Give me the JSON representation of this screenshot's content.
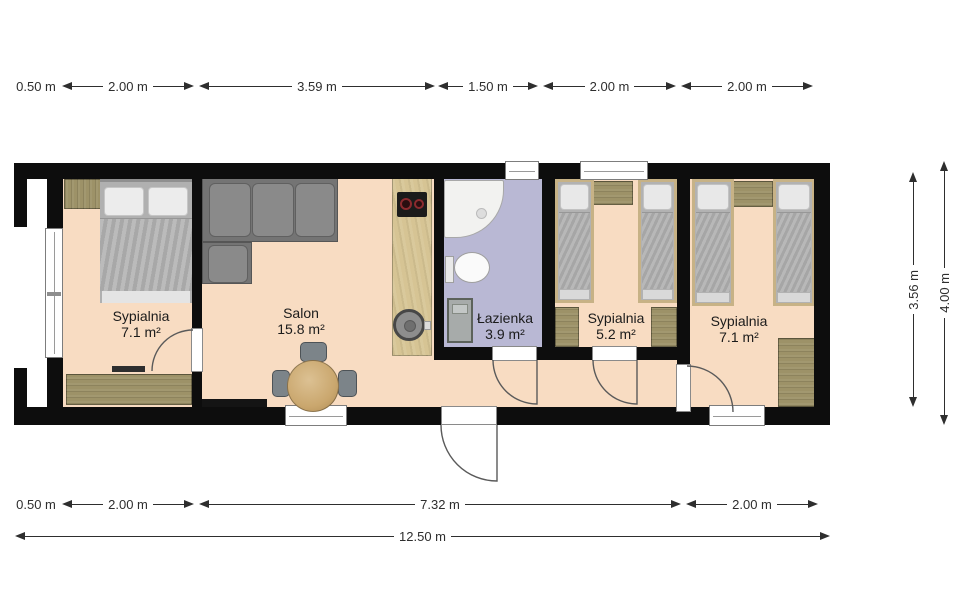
{
  "rooms": [
    {
      "name": "Sypialnia",
      "area": "7.1 m²"
    },
    {
      "name": "Salon",
      "area": "15.8 m²"
    },
    {
      "name": "Łazienka",
      "area": "3.9 m²"
    },
    {
      "name": "Sypialnia",
      "area": "5.2 m²"
    },
    {
      "name": "Sypialnia",
      "area": "7.1 m²"
    }
  ],
  "dims": {
    "top": [
      "0.50 m",
      "2.00 m",
      "3.59 m",
      "1.50 m",
      "2.00 m",
      "2.00 m"
    ],
    "bottom": [
      "0.50 m",
      "2.00 m",
      "7.32 m",
      "2.00 m"
    ],
    "overall": "12.50 m",
    "right": [
      "3.56 m",
      "4.00 m"
    ]
  },
  "colors": {
    "wall": "#0d0d0d",
    "floor": "#f8dcc2",
    "bathroom_floor": "#b9b8d4",
    "wood": "#9d9268",
    "counter": "#d6c494",
    "sofa": "#747474",
    "dimension_text": "#2e2e2e"
  }
}
